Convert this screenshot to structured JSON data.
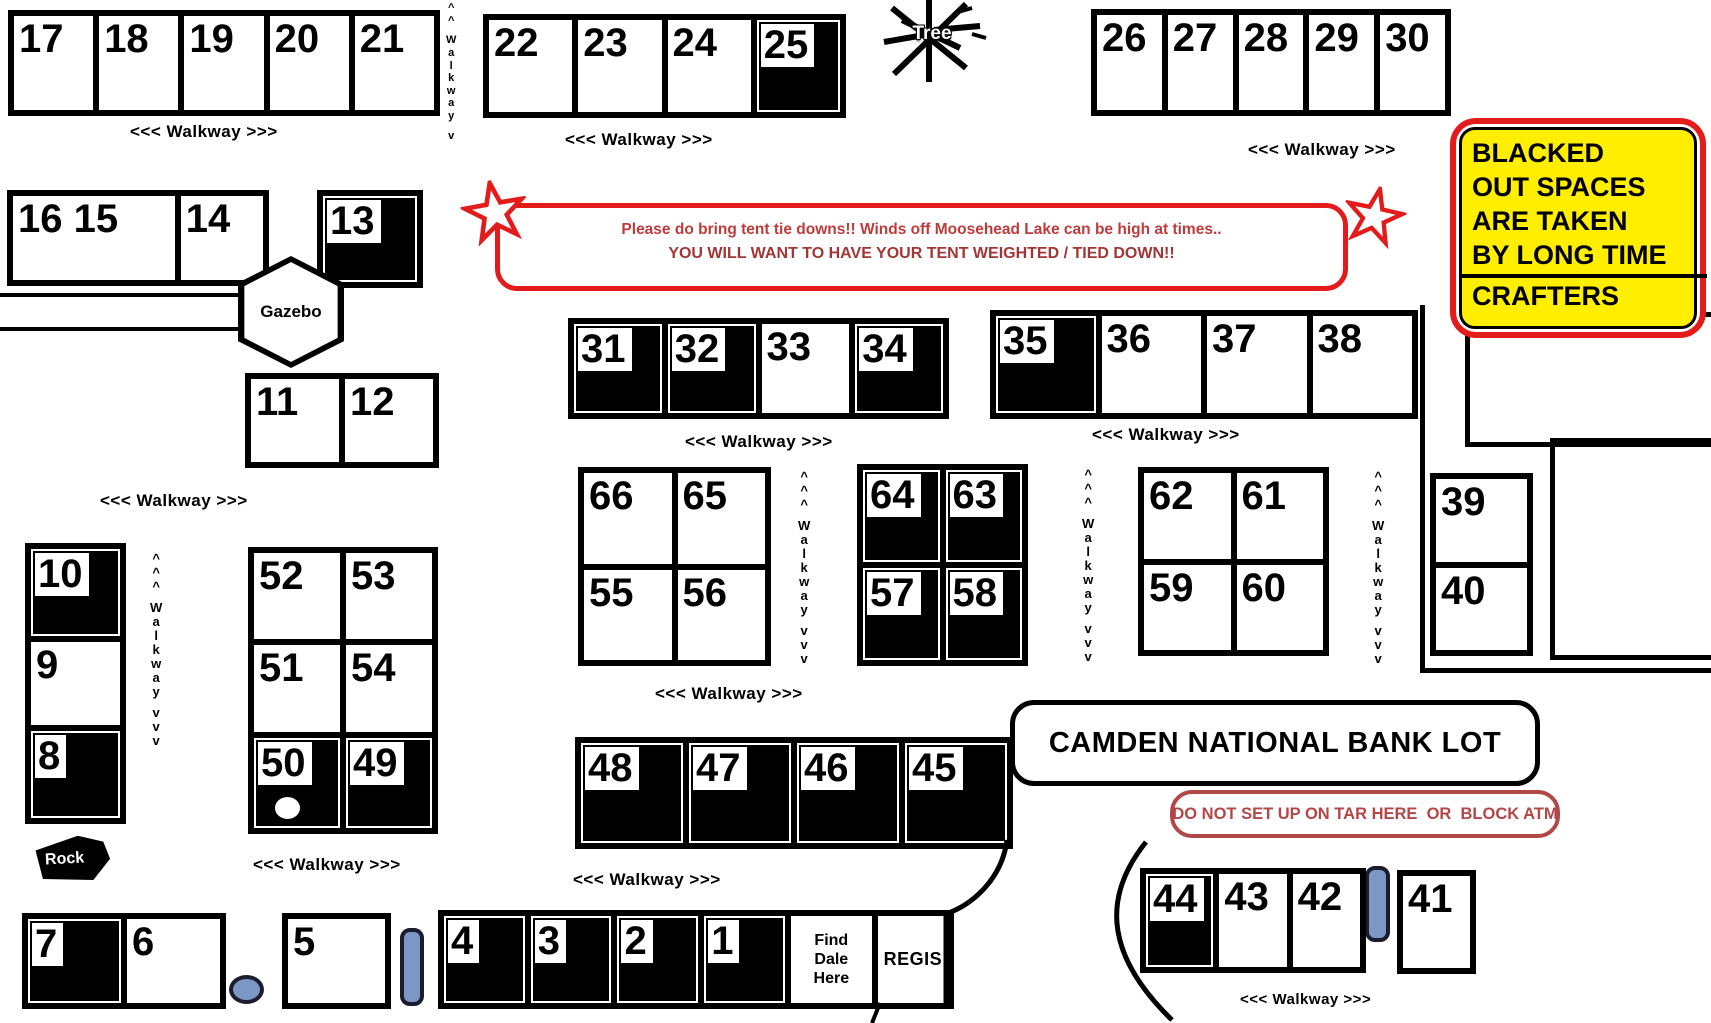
{
  "labels": {
    "walkway_h": "<<<  Walkway >>>",
    "walkway_v": [
      "^",
      "^",
      "^",
      "W",
      "a",
      "l",
      "k",
      "w",
      "a",
      "y",
      "v",
      "v",
      "v"
    ],
    "walkway_v_short": [
      "^",
      "^",
      "W",
      "a",
      "l",
      "k",
      "w",
      "a",
      "y",
      "v"
    ]
  },
  "landmarks": {
    "tree": "Tree",
    "gazebo": "Gazebo",
    "rock": "Rock"
  },
  "notices": {
    "wind_line1": "Please do bring tent tie downs!!  Winds off Moosehead Lake can be high at times..",
    "wind_line2": "YOU WILL WANT TO HAVE YOUR TENT WEIGHTED / TIED DOWN!!",
    "blacked_lines": [
      "BLACKED",
      "OUT SPACES",
      "ARE TAKEN",
      "BY LONG TIME",
      "CRAFTERS"
    ],
    "bank_lot": "CAMDEN NATIONAL BANK LOT",
    "atm": "DO NOT SET UP ON TAR HERE  OR  BLOCK ATM"
  },
  "colors": {
    "taken_space": "#000000",
    "highlight_yellow": "#ffee00",
    "alert_red": "#e31b1b",
    "notice_text_red": "#b24747",
    "marker_blue": "#7d97c5"
  },
  "booth_groups": [
    {
      "id": "g17",
      "name": "booths-17-21",
      "cells": [
        {
          "n": "17"
        },
        {
          "n": "18"
        },
        {
          "n": "19"
        },
        {
          "n": "20"
        },
        {
          "n": "21"
        }
      ]
    },
    {
      "id": "g22",
      "name": "booths-22-25",
      "cells": [
        {
          "n": "22"
        },
        {
          "n": "23"
        },
        {
          "n": "24"
        },
        {
          "n": "25",
          "filled": true
        }
      ]
    },
    {
      "id": "g26",
      "name": "booths-26-30",
      "cells": [
        {
          "n": "26"
        },
        {
          "n": "27"
        },
        {
          "n": "28"
        },
        {
          "n": "29"
        },
        {
          "n": "30"
        }
      ]
    },
    {
      "id": "g16",
      "name": "booths-16-15-14",
      "cells": [
        {
          "n": "16 15"
        },
        {
          "n": "14"
        }
      ]
    },
    {
      "id": "g13",
      "name": "booth-13",
      "cells": [
        {
          "n": "13",
          "filled": true
        }
      ]
    },
    {
      "id": "g11",
      "name": "booths-11-12",
      "cells": [
        {
          "n": "11"
        },
        {
          "n": "12"
        }
      ]
    },
    {
      "id": "g31",
      "name": "booths-31-34",
      "cells": [
        {
          "n": "31",
          "filled": true
        },
        {
          "n": "32",
          "filled": true
        },
        {
          "n": "33"
        },
        {
          "n": "34",
          "filled": true
        }
      ]
    },
    {
      "id": "g35",
      "name": "booths-35-38",
      "cells": [
        {
          "n": "35",
          "filled": true
        },
        {
          "n": "36"
        },
        {
          "n": "37"
        },
        {
          "n": "38"
        }
      ]
    },
    {
      "id": "g66",
      "name": "booths-66-65-55-56",
      "cells": [
        {
          "n": "66"
        },
        {
          "n": "65"
        },
        {
          "n": "55"
        },
        {
          "n": "56"
        }
      ]
    },
    {
      "id": "g64",
      "name": "booths-64-63-57-58",
      "cells": [
        {
          "n": "64",
          "filled": true
        },
        {
          "n": "63",
          "filled": true
        },
        {
          "n": "57",
          "filled": true
        },
        {
          "n": "58",
          "filled": true
        }
      ]
    },
    {
      "id": "g62",
      "name": "booths-62-61-59-60",
      "cells": [
        {
          "n": "62"
        },
        {
          "n": "61"
        },
        {
          "n": "59"
        },
        {
          "n": "60"
        }
      ]
    },
    {
      "id": "g39",
      "name": "booths-39-40",
      "cells": [
        {
          "n": "39"
        },
        {
          "n": "40"
        }
      ]
    },
    {
      "id": "g10",
      "name": "booths-10-9-8",
      "cells": [
        {
          "n": "10",
          "filled": true
        },
        {
          "n": "9"
        },
        {
          "n": "8",
          "filled": true
        }
      ]
    },
    {
      "id": "g52",
      "name": "booths-52-53-51-54-50-49",
      "cells": [
        {
          "n": "52"
        },
        {
          "n": "53"
        },
        {
          "n": "51"
        },
        {
          "n": "54"
        },
        {
          "n": "50",
          "filled": true,
          "circle": true
        },
        {
          "n": "49",
          "filled": true
        }
      ]
    },
    {
      "id": "g48",
      "name": "booths-48-45",
      "cells": [
        {
          "n": "48",
          "filled": true
        },
        {
          "n": "47",
          "filled": true
        },
        {
          "n": "46",
          "filled": true
        },
        {
          "n": "45",
          "filled": true
        }
      ]
    },
    {
      "id": "g7",
      "name": "booths-7-6",
      "cells": [
        {
          "n": "7",
          "filled": true
        },
        {
          "n": "6"
        }
      ]
    },
    {
      "id": "g5",
      "name": "booth-5",
      "cells": [
        {
          "n": "5"
        }
      ]
    },
    {
      "id": "g4",
      "name": "booths-4-1-registration",
      "cells": [
        {
          "n": "4",
          "filled": true
        },
        {
          "n": "3",
          "filled": true
        },
        {
          "n": "2",
          "filled": true
        },
        {
          "n": "1",
          "filled": true
        },
        {
          "lines": [
            "Find",
            "Dale",
            "Here"
          ],
          "name": "find-dale-here-booth"
        },
        {
          "text": "REGIS",
          "name": "registration-booth"
        }
      ]
    },
    {
      "id": "g44",
      "name": "booths-44-43-42",
      "cells": [
        {
          "n": "44",
          "filled": true
        },
        {
          "n": "43"
        },
        {
          "n": "42"
        }
      ]
    },
    {
      "id": "g41",
      "name": "booth-41",
      "cells": [
        {
          "n": "41"
        }
      ]
    }
  ]
}
